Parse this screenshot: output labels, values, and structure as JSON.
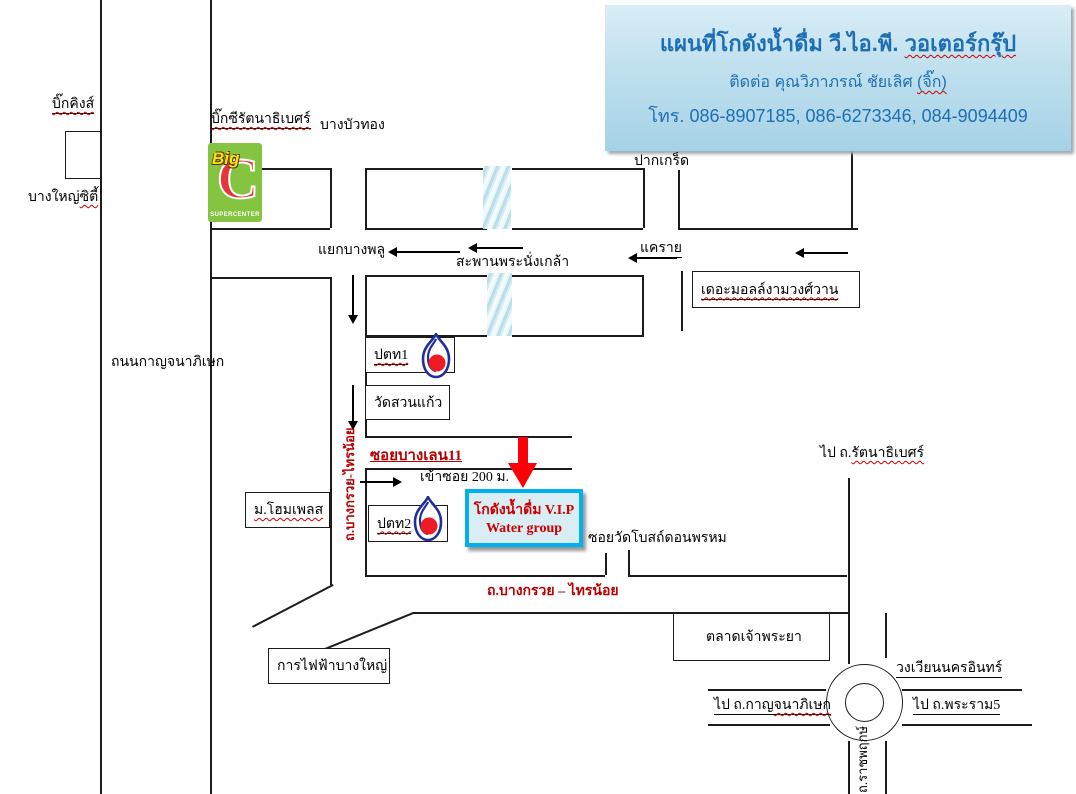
{
  "colors": {
    "accent_blue": "#1d6fb5",
    "destination_border": "#00b0f0",
    "destination_fill": "#d9edf5",
    "dark_red": "#b80000",
    "arrow_red": "#fb0007",
    "bigc_green": "#85c440",
    "bigc_red": "#e8353b",
    "bigc_yellow": "#ffe10a",
    "ptt_blue": "#232e9e",
    "ptt_red": "#ee1b24"
  },
  "title_box": {
    "line1_main": "แผนที่โกดังน้ำดื่ม วี.ไอ.พี. ",
    "line1_wavy": "วอเตอร์กรุ๊ป",
    "line2_main": "ติดต่อ คุณวิภาภรณ์ ชัยเลิศ ",
    "line2_wavy": "(จิ๊ก)",
    "line3": "โทร. 086-8907185, 086-6273346, 084-9094409"
  },
  "west": {
    "big_kings": "บิ๊กคิงส์",
    "bang_yai_city": "บางใหญ่",
    "bang_yai_city_wavy": "ซิตี้",
    "kanchanaphisek_road": "ถนนกาญจนาภิเษก"
  },
  "bigc": {
    "name": "บิ๊กซีรัตนาธิเบศร์",
    "big": "Big",
    "c": "C",
    "supercenter": "SUPERCENTER"
  },
  "north": {
    "bang_bua_thong": "บางบัวทอง",
    "pak_kret": "ปากเกร็ด",
    "yaek_bang_phlu": "แยกบางพลู",
    "phra_nangklao_bridge": "สะพานพระนั่งเกล้า",
    "khae_rai": "แคราย",
    "the_mall": "เดอะมอลล์งามวงศ์วาน"
  },
  "middle": {
    "ptt1": "ปตท1",
    "wat_suan_kaew": "วัดสวนแก้ว",
    "home_place": "ม.โฮมเพลส",
    "ptt2": "ปตท2",
    "soi_bang_len": "ซอยบางเลน11",
    "enter_soi": "เข้าซอย 200 ม.",
    "to_rattanathibet": "ไป ถ.",
    "to_rattanathibet_wavy": "รัตนาธิเบศร์",
    "soi_wat_bot": "ซอยวัดโบสถ์ดอนพรหม",
    "bangkruai_sainoi_vertical": "ถ.บางกรวย-ไทรน้อย",
    "bangkruai_sainoi_horizontal": "ถ.บางกรวย – ไทรน้อย"
  },
  "destination": {
    "line1": "โกดังน้ำดื่ม V.I.P",
    "line2": "Water group"
  },
  "south": {
    "electricity": "การไฟฟ้าบางใหญ่",
    "chao_phraya_market": "ตลาดเจ้าพระยา",
    "nakhon_in_roundabout": "วงเวียนนครอินทร์",
    "to_kanchanaphisek_a": "ไป ถ.กาญ",
    "to_kanchanaphisek_b": "จนาภิเษก",
    "to_rama5": "ไป ถ.พระราม5",
    "ratchaphruek": "ถ.ราชพฤกษ์"
  }
}
